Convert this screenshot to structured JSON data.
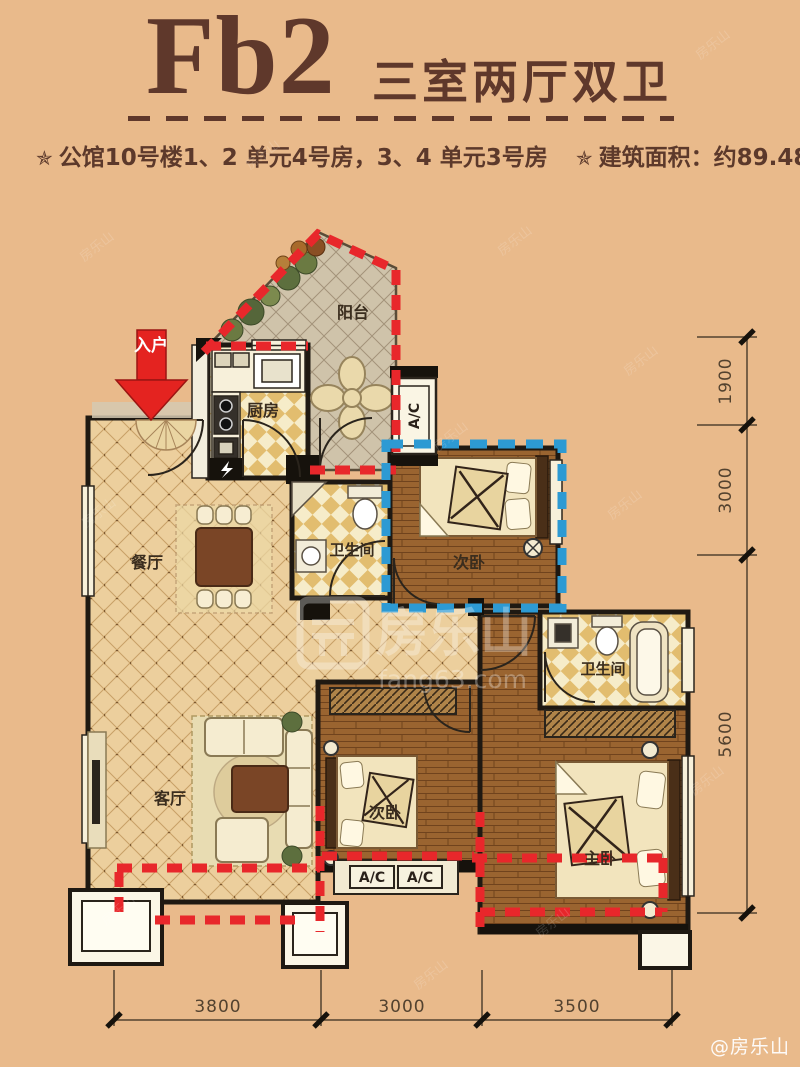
{
  "header": {
    "unit_code": "Fb2",
    "unit_type": "三室两厅双卫",
    "bullet": "✯",
    "building_info": "公馆10号楼1、2 单元4号房，3、4 单元3号房",
    "area_info": "建筑面积：约89.48m²"
  },
  "plan": {
    "labels": {
      "entry": "入户",
      "balcony": "阳台",
      "kitchen": "厨房",
      "dining": "餐厅",
      "living": "客厅",
      "bathroom": "卫生间",
      "bedroom": "次卧",
      "master": "主卧",
      "ac": "A/C"
    },
    "dims_right": [
      "1900",
      "3000",
      "5600"
    ],
    "dims_bottom": [
      "3800",
      "3000",
      "3500"
    ]
  },
  "watermark": {
    "brand": "房乐山",
    "site": "fang63.com",
    "handle": "@房乐山"
  },
  "colors": {
    "background": "#e9ba8b",
    "title_brown": "#5f382b",
    "accent_red": "#e8272b",
    "accent_blue": "#2d9ad3",
    "wall": "#1f1912",
    "wood_floor": "#9a6430",
    "tile_light": "#eccf9d"
  }
}
